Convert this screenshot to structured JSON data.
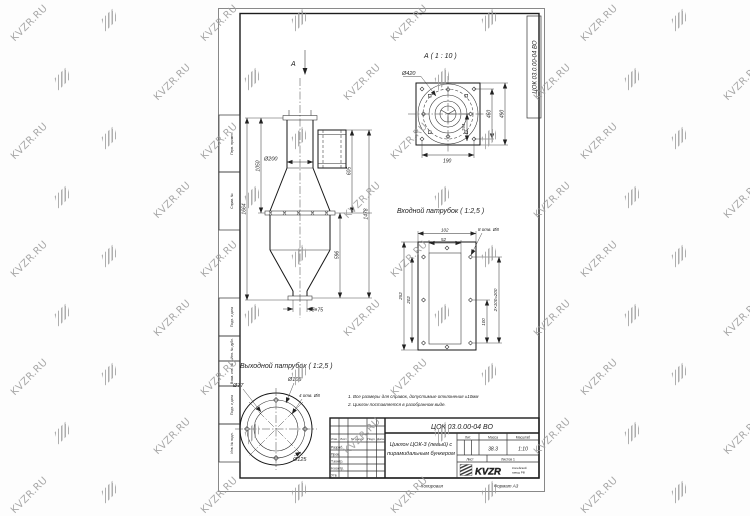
{
  "watermark": {
    "text": "KVZR.RU"
  },
  "frame": {
    "doc_number_vertical": "ЦОК 03.0.00-04 ВО",
    "stamp_columns": [
      "Перв. примен.",
      "Справ. №",
      "Подп. и дата",
      "Инв. № дубл.",
      "Взам. инв. №",
      "Подп. и дата",
      "Инв. № подл."
    ],
    "copied_label": "Копировал",
    "format_label": "Формат А3"
  },
  "views": {
    "main": {
      "arrow_label": "А",
      "dia_body": "Ø200",
      "h_total": "1664",
      "h_upper": "1050",
      "h_inlet": "605",
      "h_hopper": "596",
      "h_right": "1478",
      "outlet_size": "75×75"
    },
    "detail": {
      "title": "А ( 1 : 10 )",
      "dia": "Ø420",
      "sq_inner": "460",
      "sq_outer": "490",
      "w_bottom": "190",
      "w_inner": "194"
    },
    "inlet": {
      "title": "Входной патрубок ( 1:2,5 )",
      "w_outer": "102",
      "w_inner": "52",
      "holes": "8 отв. Ø8",
      "h_outer": "252",
      "h_inner": "202",
      "pitch": "2×100=200",
      "pitch_half": "100"
    },
    "outlet": {
      "title": "Выходной патрубок ( 1:2,5 )",
      "d_inner": "Ø77",
      "d_bolt": "Ø105",
      "holes": "4 отв. Ø8",
      "d_outer": "Ø125"
    }
  },
  "notes": {
    "line1": "1. Все размеры для справок, допустимые отклонения ±10мм",
    "line2": "2. Циклон поставляется в разобранном виде."
  },
  "title_block": {
    "doc_number": "ЦОК 03.0.00-04 ВО",
    "name_line1": "Циклон ЦОК-3 (левый) с",
    "name_line2": "пирамидальным бункером",
    "col_izm": "Изм.",
    "col_list": "Лист",
    "col_doc": "№ докум.",
    "col_sign": "Подп.",
    "col_date": "Дата",
    "row_developed": "Разраб.",
    "row_checked": "Пров.",
    "row_tcontrol": "Т.контр.",
    "row_ncontrol": "Н.контр.",
    "row_approved": "Утв.",
    "lit_label": "Лит.",
    "mass_label": "Масса",
    "scale_label": "Масштаб",
    "mass_value": "38.3",
    "scale_value": "1:10",
    "sheet_label": "Лист",
    "sheets_label": "Листов 1",
    "logo_text": "KVZR",
    "logo_caption1": "Копейский",
    "logo_caption2": "завод РФ"
  }
}
